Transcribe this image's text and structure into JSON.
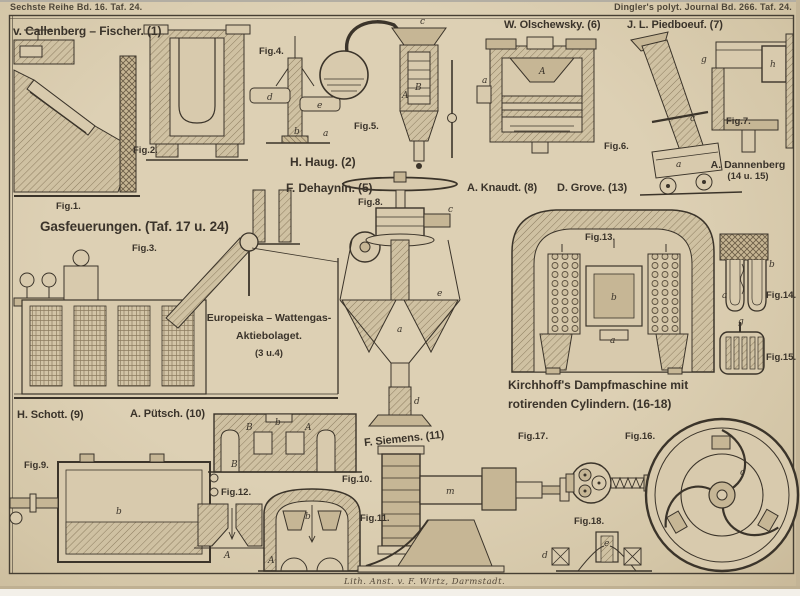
{
  "page": {
    "header_left": "Sechste Reihe Bd. 16. Taf. 24.",
    "header_right": "Dingler's polyt. Journal Bd. 266. Taf. 24.",
    "imprint": "Lith. Anst. v. F. Wirtz, Darmstadt."
  },
  "captions": {
    "callenberg": "v. Callenberg – Fischer. (1)",
    "olschewsky": "W. Olschewsky. (6)",
    "piedboeuf": "J. L. Piedboeuf. (7)",
    "haug": "H. Haug. (2)",
    "dehaynin": "F. Dehaynin. (5)",
    "knaudt": "A. Knaudt. (8)",
    "grove": "D. Grove. (13)",
    "dannenberg_name": "A. Dannenberg",
    "dannenberg_figs": "(14 u. 15)",
    "gasfeuerungen": "Gasfeuerungen. (Taf. 17 u. 24)",
    "europeiska_line1": "Europeiska – Wattengas-",
    "europeiska_line2": "Aktiebolaget.",
    "europeiska_line3": "(3 u.4)",
    "schott": "H. Schott. (9)",
    "puetsch": "A. Pütsch. (10)",
    "siemens": "F. Siemens. (11)",
    "kirchhoff_line1": "Kirchhoff's Dampfmaschine mit",
    "kirchhoff_line2": "rotirenden Cylindern. (16-18)"
  },
  "fig_labels": [
    "Fig.1.",
    "Fig.2.",
    "Fig.3.",
    "Fig.4.",
    "Fig.5.",
    "Fig.6.",
    "Fig.7.",
    "Fig.8.",
    "Fig.9.",
    "Fig.10.",
    "Fig.11.",
    "Fig.12.",
    "Fig.13.",
    "Fig.14.",
    "Fig.15.",
    "Fig.16.",
    "Fig.17.",
    "Fig.18."
  ],
  "letters": {
    "fig4_d": "d",
    "fig4_e": "e",
    "fig4_b": "b",
    "fig4_a": "a",
    "fig5_c": "c",
    "fig5_A": "A",
    "fig5_B": "B",
    "fig6_A": "A",
    "fig6_a": "a",
    "fig7_g": "g",
    "fig7_c": "c",
    "fig7_a": "a",
    "fig7_h": "h",
    "fig8_c": "c",
    "fig8_e": "e",
    "fig8_a": "a",
    "fig8_d": "d",
    "fig9_b": "b",
    "fig10_B1": "B",
    "fig10_b": "b",
    "fig10_B2": "B",
    "fig10_A": "A",
    "fig11_b": "b",
    "fig11_A": "A",
    "fig12_A": "A",
    "fig13_b": "b",
    "fig13_a": "a",
    "fig14_a": "a",
    "fig14_b": "b",
    "fig15_g": "g",
    "fig16_c": "c",
    "fig17_m": "m",
    "fig18_e": "e",
    "fig18_d": "d"
  },
  "colors": {
    "paper": "#d8caad",
    "ink": "#3b342a",
    "hatch": "#8d7d60",
    "shade": "#c6b695",
    "frame": "#463f33"
  }
}
